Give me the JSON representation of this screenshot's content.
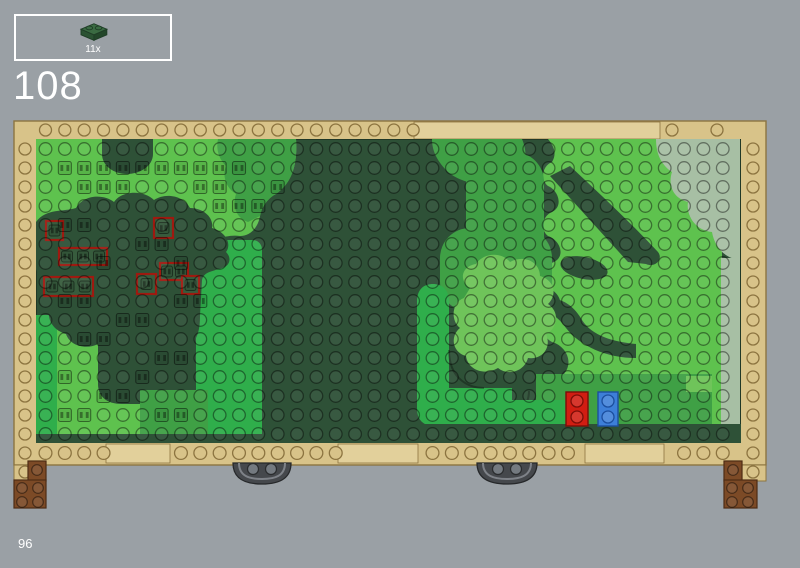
{
  "page": {
    "background_color": "#9aa0a5",
    "step_number": "108",
    "page_number": "96",
    "text_color": "#ffffff"
  },
  "parts_panel": {
    "border_color": "#ffffff",
    "pieces": [
      {
        "name": "plate-1x2-dark-green",
        "count_label": "11x",
        "color_top": "#3a6b42",
        "color_left": "#2a5232",
        "color_right": "#224629",
        "color_edge": "#1f3d26"
      }
    ]
  },
  "model": {
    "name": "park-baseplate-top-view",
    "palette": {
      "tan": "#d8c389",
      "tan_light": "#e2d09b",
      "tan_edge": "#8c7440",
      "base_dark_green": "#2e5137",
      "bright_green": "#5ec24e",
      "medium_green": "#3fa045",
      "emerald_green": "#2fae4b",
      "pale_green": "#6fc45a",
      "sage_green": "#a7bfa4",
      "highlight_red": "#9e1a10",
      "accent_red": "#d11d12",
      "accent_red_edge": "#7c0e08",
      "accent_blue": "#3d7fd8",
      "accent_blue_edge": "#1c4f9e",
      "brown": "#7c4a26",
      "brown_edge": "#4e2c14",
      "wheel_gray": "#45484c",
      "wheel_rim": "#7e8288",
      "wheel_edge": "#26282a"
    },
    "highlighted_new_piece_outlines": 7,
    "accent_plates": [
      {
        "name": "red-plate-1x2",
        "color": "#d11d12"
      },
      {
        "name": "blue-plate-1x2",
        "color": "#3d7fd8"
      }
    ]
  }
}
